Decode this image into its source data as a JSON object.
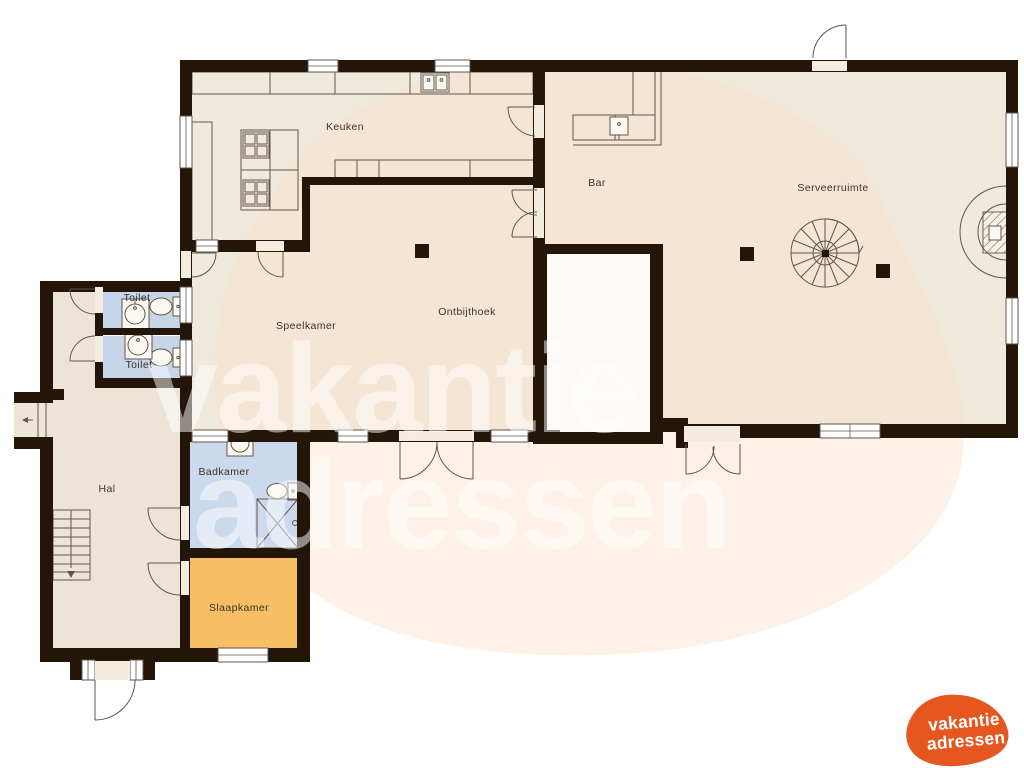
{
  "title": "Vakantiehuis plattegrond begane grond",
  "colors": {
    "wall": "#241509",
    "floor_beige": "#f0eadc",
    "floor_hal": "#ece5d7",
    "toilet_blue": "#c7d5e8",
    "badkamer_blue": "#cbd9ec",
    "slaapkamer_orange": "#f6bf63",
    "white_room": "#fffaf7",
    "blob_pink": "#fbdfcd",
    "threshold": "#f3ecdf",
    "fixture": "#5f564b",
    "label": "#3a332b",
    "logo_orange": "#e5571f"
  },
  "floorplan": {
    "rooms": [
      {
        "id": "keuken",
        "label": "Keuken"
      },
      {
        "id": "bar",
        "label": "Bar"
      },
      {
        "id": "serveerruimte",
        "label": "Serveerruimte"
      },
      {
        "id": "speelkamer",
        "label": "Speelkamer"
      },
      {
        "id": "ontbijthoek",
        "label": "Ontbijthoek"
      },
      {
        "id": "toilet-1",
        "label": "Toilet"
      },
      {
        "id": "toilet-2",
        "label": "Toilet"
      },
      {
        "id": "hal",
        "label": "Hal"
      },
      {
        "id": "badkamer",
        "label": "Badkamer"
      },
      {
        "id": "slaapkamer",
        "label": "Slaapkamer"
      }
    ],
    "fixtures": [
      "spiral-staircase",
      "fireplace",
      "stove",
      "kitchen-sink",
      "bar-sink",
      "toilet-fixture",
      "washbasin",
      "shower",
      "staircase",
      "entrance-arrow"
    ]
  },
  "watermark": {
    "line1": "vakantie",
    "line2": "adressen"
  },
  "logo": {
    "line1": "vakantie",
    "line2": "adressen"
  }
}
